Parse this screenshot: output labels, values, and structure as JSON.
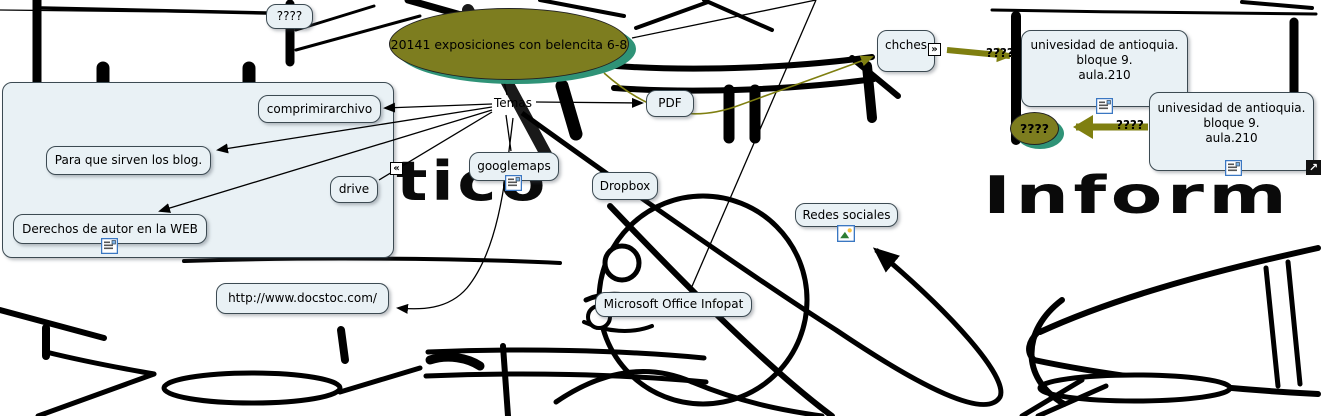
{
  "title": "concept map - exposiciones con belencita",
  "background": {
    "word_left": "tico",
    "word_right": "Inform"
  },
  "colors": {
    "concept_fill": "#e9f1f5",
    "concept_border": "#3c4a52",
    "ellipse_fill": "#7d7d1f",
    "ellipse_shadow": "#2f9377",
    "olive_link": "#7f7f10",
    "link_black": "#000000",
    "resource_icon_border": "#3a77c2"
  },
  "concepts": {
    "main": {
      "label": "20141 exposiciones con belencita 6-8"
    },
    "unknown_top": {
      "label": "????"
    },
    "temas": {
      "label": "Temas"
    },
    "comprimirarchivo": {
      "label": "comprimirarchivo"
    },
    "blogs": {
      "label": "Para que sirven los blog."
    },
    "drive": {
      "label": "drive"
    },
    "derechos": {
      "label": "Derechos de autor en la WEB"
    },
    "docstoc": {
      "label": "http://www.docstoc.com/"
    },
    "googlemaps": {
      "label": "googlemaps"
    },
    "dropbox": {
      "label": "Dropbox"
    },
    "pdf": {
      "label": "PDF"
    },
    "infopath": {
      "label": "Microsoft Office Infopat"
    },
    "redes_sociales": {
      "label": "Redes sociales"
    },
    "chches": {
      "label": "chches"
    },
    "universidad_1": {
      "line1": "univesidad de antioquia.",
      "line2": "bloque 9.",
      "line3": "aula.210"
    },
    "universidad_2": {
      "line1": "univesidad de antioquia.",
      "line2": "bloque 9.",
      "line3": "aula.210"
    },
    "unknown_ellipse": {
      "label": "????"
    }
  },
  "link_labels": {
    "chches_to_univ1": "????",
    "univ2_to_unknown": "????"
  },
  "icons": {
    "collapse_left": "«",
    "collapse_right": "»",
    "open_new": "↗"
  }
}
